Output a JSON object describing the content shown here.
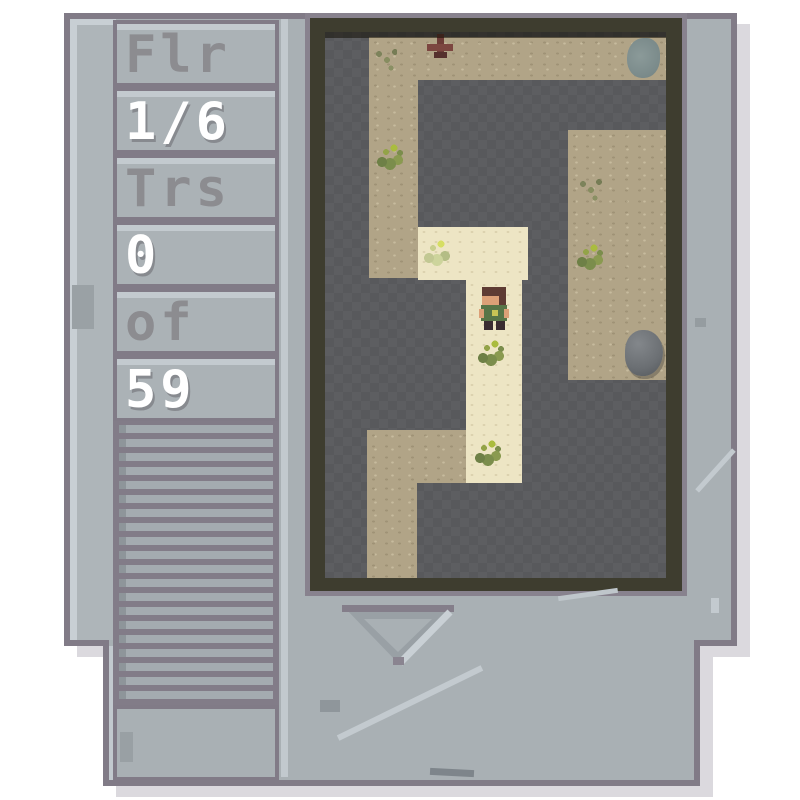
{
  "hud": {
    "rows": [
      {
        "id": "floor-label",
        "text": "Flr",
        "variant": "dim"
      },
      {
        "id": "floor-value",
        "text": "1/6",
        "variant": "bright"
      },
      {
        "id": "treasure-label",
        "text": "Trs",
        "variant": "dim"
      },
      {
        "id": "treasure-value",
        "text": "0",
        "variant": "bright"
      },
      {
        "id": "treasure-of",
        "text": "of",
        "variant": "dim"
      },
      {
        "id": "treasure-total",
        "text": "59",
        "variant": "bright"
      }
    ]
  },
  "colors": {
    "cartridge_body": "#a9b0b4",
    "cartridge_outline": "#817b87",
    "edge_highlight": "#c8cfd4",
    "screen_frame": "#3e3d2f",
    "rock_floor": "#58595c",
    "sand_floor": "#b1a487",
    "lit_floor": "#ede5c4",
    "hud_dim_text": "#8c8c90",
    "hud_bright_text": "#ffffff",
    "drop_shadow": "#dbd9de",
    "player_shirt": "#587547",
    "player_hair": "#5e3b33",
    "grass": "#7b8d4c"
  },
  "map": {
    "regions": [
      {
        "name": "sand-top-band",
        "terrain": "sand",
        "x": 44,
        "y": 5,
        "w": 297,
        "h": 43
      },
      {
        "name": "sand-left-column",
        "terrain": "sand",
        "x": 44,
        "y": 48,
        "w": 49,
        "h": 198
      },
      {
        "name": "lit-room-upper",
        "terrain": "lit",
        "x": 93,
        "y": 195,
        "w": 110,
        "h": 53
      },
      {
        "name": "lit-corridor",
        "terrain": "lit",
        "x": 141,
        "y": 248,
        "w": 56,
        "h": 203
      },
      {
        "name": "sand-bottom-branch",
        "terrain": "sand",
        "x": 42,
        "y": 398,
        "w": 99,
        "h": 53
      },
      {
        "name": "sand-bottom-leg",
        "terrain": "sand",
        "x": 42,
        "y": 451,
        "w": 50,
        "h": 95
      },
      {
        "name": "sand-right-room",
        "terrain": "sand",
        "x": 243,
        "y": 98,
        "w": 98,
        "h": 250
      }
    ],
    "entities": [
      {
        "name": "player",
        "type": "player",
        "x": 154,
        "y": 255,
        "w": 30,
        "h": 44
      },
      {
        "name": "boulder",
        "type": "boulder",
        "x": 300,
        "y": 298,
        "w": 38,
        "h": 46
      },
      {
        "name": "stone-patch",
        "type": "bluestone",
        "x": 302,
        "y": 6,
        "w": 33,
        "h": 40
      },
      {
        "name": "dead-shrub",
        "type": "shrub",
        "x": 100,
        "y": 2,
        "w": 30,
        "h": 28
      },
      {
        "name": "grass-tuft-1",
        "type": "grass",
        "x": 48,
        "y": 104,
        "w": 34,
        "h": 34
      },
      {
        "name": "grass-tuft-2",
        "type": "grass",
        "x": 248,
        "y": 204,
        "w": 34,
        "h": 34
      },
      {
        "name": "grass-tuft-3",
        "type": "grass",
        "x": 149,
        "y": 300,
        "w": 34,
        "h": 36
      },
      {
        "name": "grass-tuft-4",
        "type": "grass",
        "x": 146,
        "y": 400,
        "w": 40,
        "h": 40
      },
      {
        "name": "grass-pale-1",
        "type": "grass-pale",
        "x": 95,
        "y": 200,
        "w": 42,
        "h": 40
      },
      {
        "name": "grass-faint-1",
        "type": "grass-faint",
        "x": 250,
        "y": 144,
        "w": 36,
        "h": 30
      },
      {
        "name": "grass-faint-2",
        "type": "grass-faint",
        "x": 46,
        "y": 14,
        "w": 26,
        "h": 26
      }
    ]
  }
}
